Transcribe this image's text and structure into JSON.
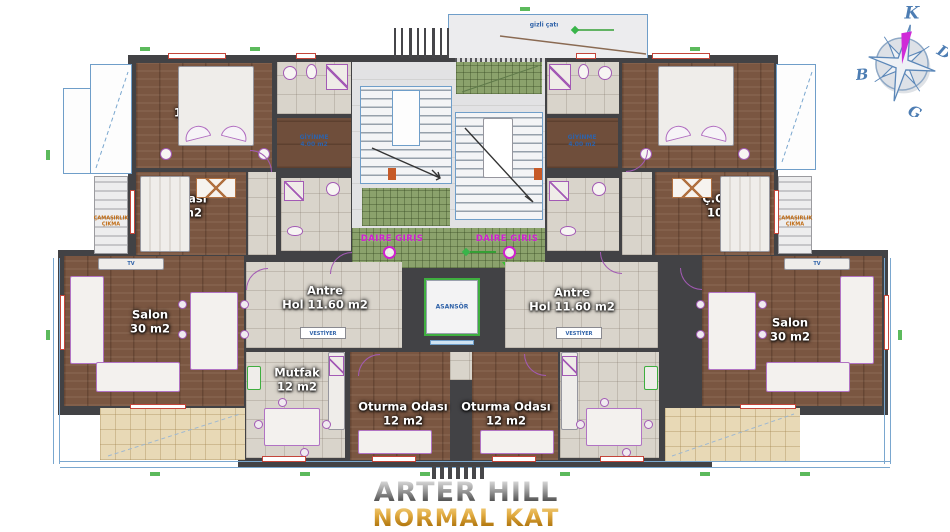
{
  "title": {
    "project": "ARTER HILL",
    "floor": "NORMAL KAT"
  },
  "compass": {
    "north": "K",
    "east": "D",
    "west": "B",
    "south": "G"
  },
  "core": {
    "elevator": "ASANSÖR",
    "entrance_left": "DAIRE GIRIS",
    "entrance_right": "DAIRE GIRIS",
    "roof_note": "gizli çatı"
  },
  "apartment_left": {
    "bedroom": {
      "name": "Y.Odası",
      "area": "18.50 m2"
    },
    "child_room": {
      "name": "Ç.Odası",
      "area": "10 m2"
    },
    "salon": {
      "name": "Salon",
      "area": "30 m2"
    },
    "hall": {
      "name": "Antre",
      "detail": "Hol 11.60 m2"
    },
    "kitchen": {
      "name": "Mutfak",
      "area": "12 m2"
    },
    "living": {
      "name": "Oturma Odası",
      "area": "12 m2"
    },
    "dressing": {
      "name": "GİYİNME",
      "area": "4.00 m2"
    },
    "closet": "VESTİYER",
    "tv": "TV",
    "note": {
      "line1": "ÇAMAŞIRLIK",
      "line2": "ÇIKMA"
    }
  },
  "apartment_right": {
    "bedroom": {
      "name": "Y.Odası",
      "area": "18.50 m2"
    },
    "child_room": {
      "name": "Ç.Odası",
      "area": "10 m2"
    },
    "salon": {
      "name": "Salon",
      "area": "30 m2"
    },
    "hall": {
      "name": "Antre",
      "detail": "Hol 11.60 m2"
    },
    "living": {
      "name": "Oturma Odası",
      "area": "12 m2"
    },
    "dressing": {
      "name": "GİYİNME",
      "area": "4.00 m2"
    },
    "closet": "VESTİYER",
    "tv": "TV",
    "note": {
      "line1": "ÇAMAŞIRLIK",
      "line2": "ÇIKMA"
    }
  }
}
